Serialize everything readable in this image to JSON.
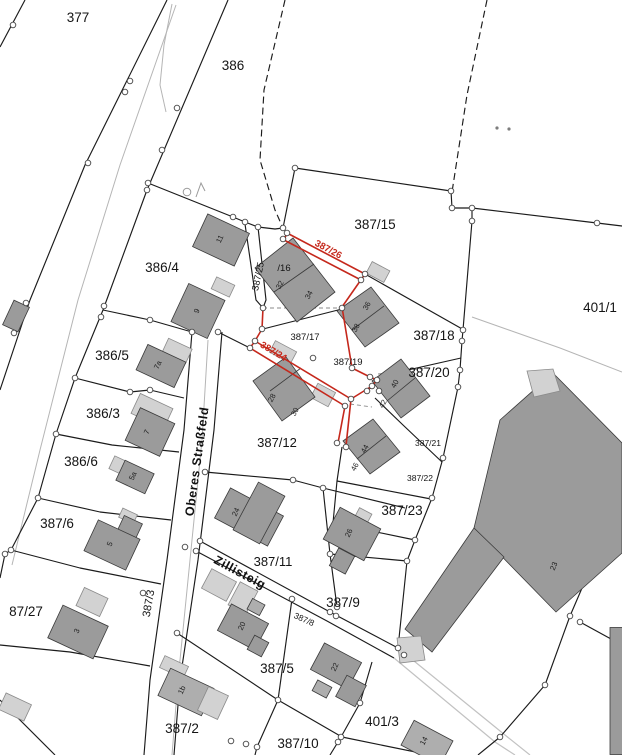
{
  "map": {
    "type": "cadastral-parcel-map",
    "colors": {
      "background": "#ffffff",
      "boundary": "#1b1b1b",
      "road_gray": "#b5b5b5",
      "light_path": "#c2c2c2",
      "building_dark": "#9b9b9b",
      "building_mid": "#aeaeae",
      "building_light": "#d2d2d2",
      "building_stroke": "#3a3a3a",
      "highlight_red": "#c5281c",
      "vertex_fill": "#ffffff",
      "vertex_stroke": "#444444",
      "label": "#141414"
    },
    "parcel_labels": [
      {
        "text": "377",
        "x": 78,
        "y": 22,
        "rot": 0,
        "size": 13.5
      },
      {
        "text": "386",
        "x": 233,
        "y": 70,
        "rot": 0,
        "size": 13.5
      },
      {
        "text": "386/4",
        "x": 162,
        "y": 272,
        "rot": 0,
        "size": 13.5
      },
      {
        "text": "386/5",
        "x": 112,
        "y": 360,
        "rot": 0,
        "size": 13.5
      },
      {
        "text": "386/3",
        "x": 103,
        "y": 418,
        "rot": 0,
        "size": 13.5
      },
      {
        "text": "386/6",
        "x": 81,
        "y": 466,
        "rot": 0,
        "size": 13.5
      },
      {
        "text": "387/6",
        "x": 57,
        "y": 528,
        "rot": 0,
        "size": 13.5
      },
      {
        "text": "87/27",
        "x": 26,
        "y": 616,
        "rot": 0,
        "size": 13.5
      },
      {
        "text": "387/3",
        "x": 152,
        "y": 604,
        "rot": -80,
        "size": 11
      },
      {
        "text": "387/15",
        "x": 375,
        "y": 229,
        "rot": 0,
        "size": 13.5
      },
      {
        "text": "387/25",
        "x": 261,
        "y": 277,
        "rot": -78,
        "size": 9.5
      },
      {
        "text": "/16",
        "x": 284,
        "y": 271,
        "rot": 0,
        "size": 9.5
      },
      {
        "text": "387/17",
        "x": 305,
        "y": 340,
        "rot": 0,
        "size": 9.5
      },
      {
        "text": "387/19",
        "x": 348,
        "y": 365,
        "rot": 0,
        "size": 9.5
      },
      {
        "text": "387/18",
        "x": 434,
        "y": 340,
        "rot": 0,
        "size": 13.5
      },
      {
        "text": "401/1",
        "x": 600,
        "y": 312,
        "rot": 0,
        "size": 13.5
      },
      {
        "text": "387/20",
        "x": 429,
        "y": 377,
        "rot": 0,
        "size": 13.5
      },
      {
        "text": "387/12",
        "x": 277,
        "y": 447,
        "rot": 0,
        "size": 13
      },
      {
        "text": "387/21",
        "x": 428,
        "y": 446,
        "rot": 0,
        "size": 8.5
      },
      {
        "text": "387/22",
        "x": 420,
        "y": 481,
        "rot": 0,
        "size": 8.5
      },
      {
        "text": "387/23",
        "x": 402,
        "y": 515,
        "rot": 0,
        "size": 13.5
      },
      {
        "text": "387/11",
        "x": 273,
        "y": 566,
        "rot": 0,
        "size": 13
      },
      {
        "text": "387/9",
        "x": 343,
        "y": 607,
        "rot": 0,
        "size": 13.5
      },
      {
        "text": "387/8",
        "x": 303,
        "y": 622,
        "rot": 24,
        "size": 8.5
      },
      {
        "text": "387/5",
        "x": 277,
        "y": 673,
        "rot": 0,
        "size": 13.5
      },
      {
        "text": "387/2",
        "x": 182,
        "y": 733,
        "rot": 0,
        "size": 13.5
      },
      {
        "text": "387/10",
        "x": 298,
        "y": 748,
        "rot": 0,
        "size": 13.5
      },
      {
        "text": "401/3",
        "x": 382,
        "y": 726,
        "rot": 0,
        "size": 13.5
      }
    ],
    "street_labels": [
      {
        "text": "Oberes Straßfeld",
        "x": 201,
        "y": 462,
        "rot": -82,
        "size": 12.5
      },
      {
        "text": "Zillisteig",
        "x": 238,
        "y": 576,
        "rot": 28,
        "size": 12.5
      }
    ],
    "highlight_labels": [
      {
        "text": "387/26",
        "x": 327,
        "y": 252,
        "rot": 28,
        "size": 9.5
      },
      {
        "text": "387/24",
        "x": 272,
        "y": 354,
        "rot": 31,
        "size": 9.5
      }
    ],
    "house_numbers": [
      {
        "text": "11",
        "x": 222,
        "y": 240,
        "rot": -65
      },
      {
        "text": "9",
        "x": 199,
        "y": 312,
        "rot": -65
      },
      {
        "text": "7a",
        "x": 160,
        "y": 366,
        "rot": -65
      },
      {
        "text": "7",
        "x": 149,
        "y": 433,
        "rot": -65
      },
      {
        "text": "5a",
        "x": 135,
        "y": 477,
        "rot": -65
      },
      {
        "text": "5",
        "x": 112,
        "y": 545,
        "rot": -65
      },
      {
        "text": "3",
        "x": 79,
        "y": 632,
        "rot": -65
      },
      {
        "text": "1b",
        "x": 184,
        "y": 691,
        "rot": -65
      },
      {
        "text": "32",
        "x": 282,
        "y": 286,
        "rot": -62
      },
      {
        "text": "34",
        "x": 311,
        "y": 296,
        "rot": -62
      },
      {
        "text": "36",
        "x": 369,
        "y": 307,
        "rot": -62
      },
      {
        "text": "38",
        "x": 358,
        "y": 329,
        "rot": -62
      },
      {
        "text": "28",
        "x": 274,
        "y": 399,
        "rot": -62
      },
      {
        "text": "30",
        "x": 297,
        "y": 413,
        "rot": -62
      },
      {
        "text": "40",
        "x": 397,
        "y": 385,
        "rot": -62
      },
      {
        "text": "42",
        "x": 385,
        "y": 405,
        "rot": -62
      },
      {
        "text": "44",
        "x": 367,
        "y": 450,
        "rot": -62
      },
      {
        "text": "46",
        "x": 357,
        "y": 468,
        "rot": -62
      },
      {
        "text": "24",
        "x": 238,
        "y": 513,
        "rot": -65
      },
      {
        "text": "26",
        "x": 351,
        "y": 534,
        "rot": -65
      },
      {
        "text": "20",
        "x": 244,
        "y": 627,
        "rot": -65
      },
      {
        "text": "22",
        "x": 337,
        "y": 668,
        "rot": -65
      },
      {
        "text": "14",
        "x": 426,
        "y": 742,
        "rot": -62
      },
      {
        "text": "23",
        "x": 556,
        "y": 567,
        "rot": -67
      }
    ]
  }
}
